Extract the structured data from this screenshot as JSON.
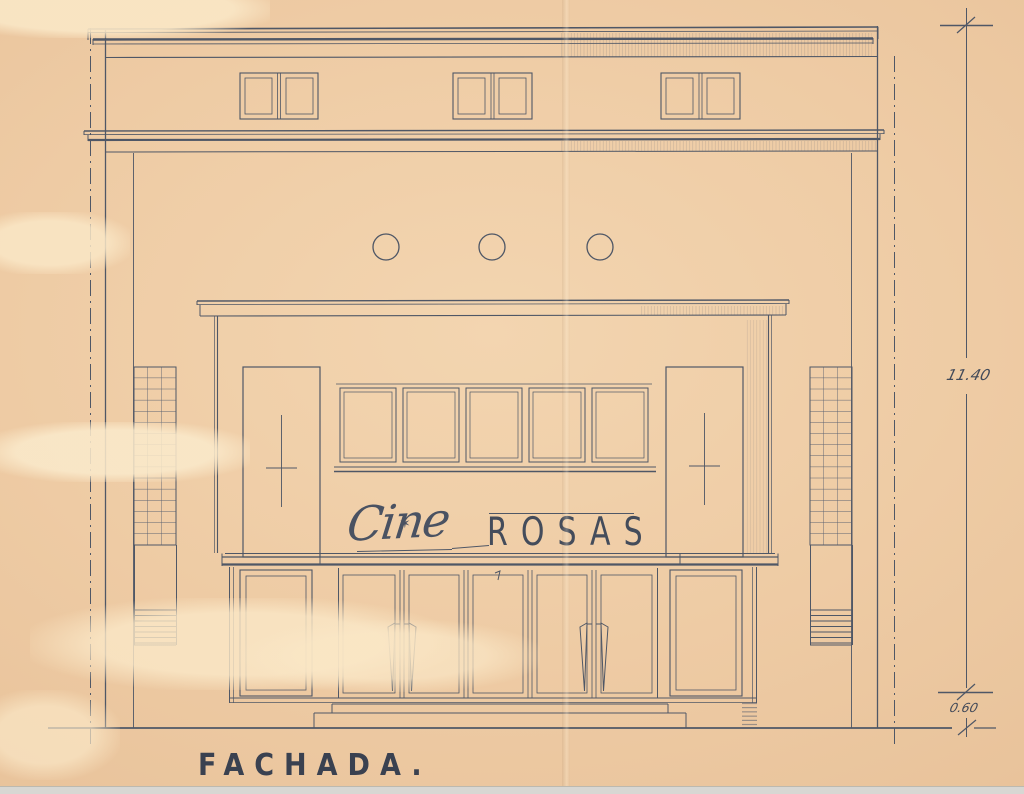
{
  "document": {
    "caption": "FACHADA.",
    "sign": {
      "script_word": "Cine",
      "star_glyph": "✶",
      "main_word": "ROSAS"
    },
    "dimensions": {
      "overall_height": "11.40",
      "base_height": "0.60"
    },
    "colors": {
      "paper": "#eecba4",
      "stain": "#f8e4c2",
      "ink": "#4f5766",
      "text_ink": "#3a4150",
      "scan_edge": "#d8d7d3"
    }
  }
}
